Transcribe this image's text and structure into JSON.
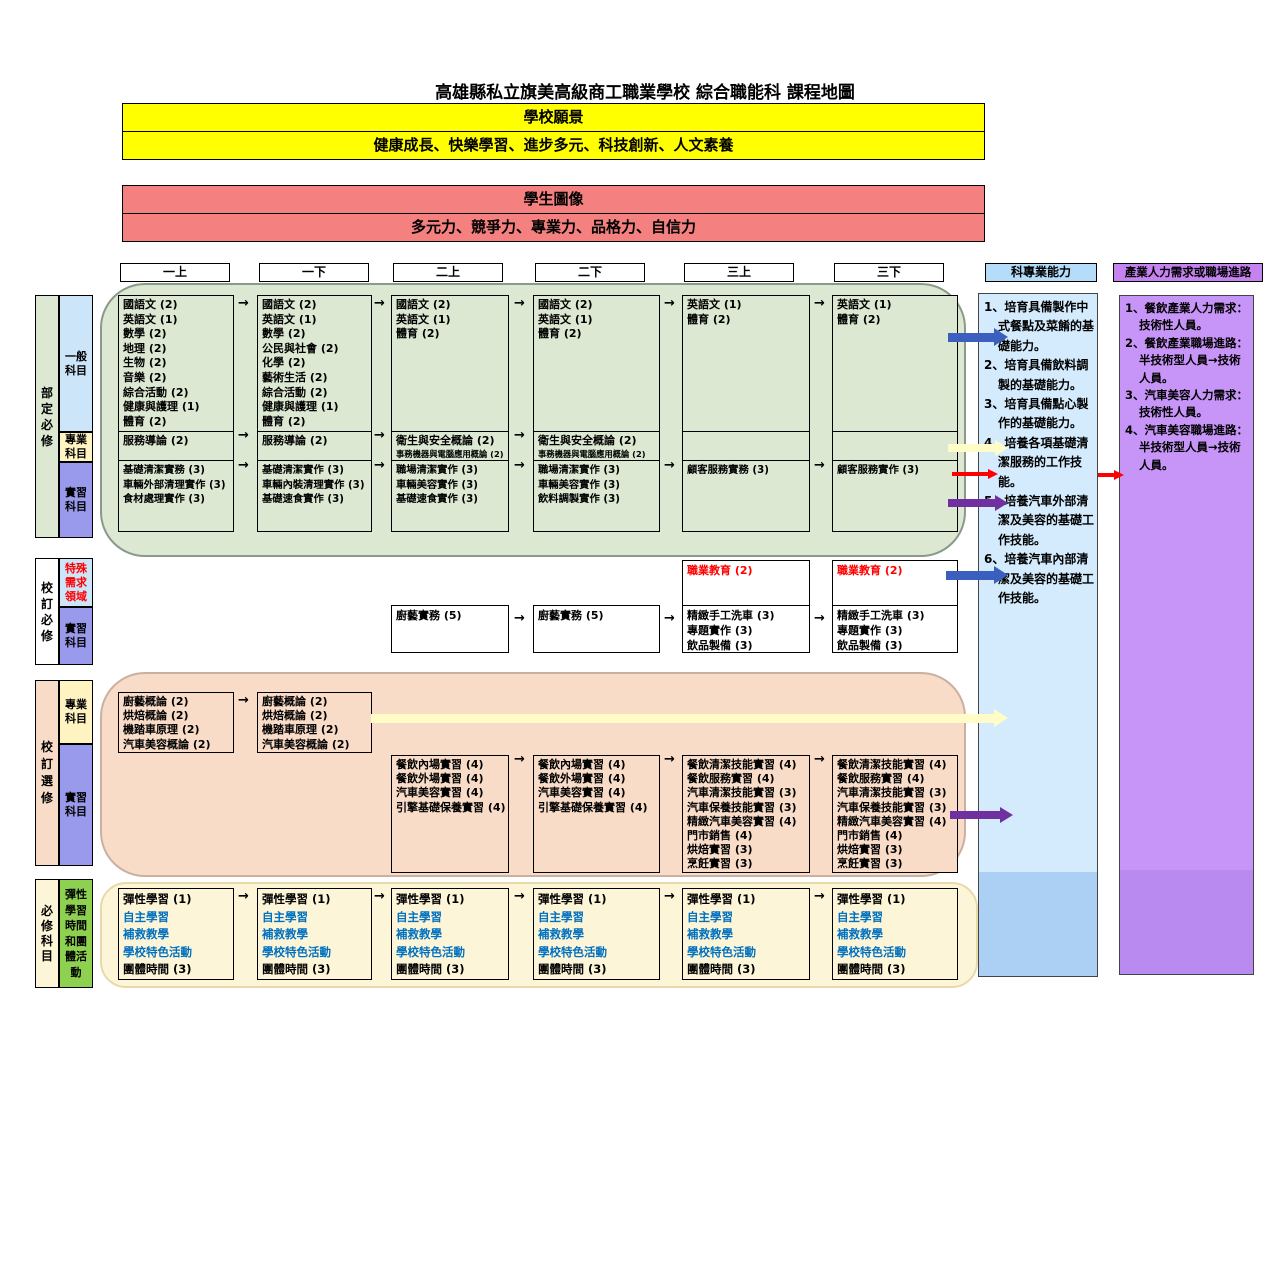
{
  "title": "高雄縣私立旗美高級商工職業學校 綜合職能科 課程地圖",
  "vision": {
    "header": "學校願景",
    "content": "健康成長、快樂學習、進步多元、科技創新、人文素養"
  },
  "student_image": {
    "header": "學生圖像",
    "content": "多元力、競爭力、專業力、品格力、自信力"
  },
  "semesters": [
    "一上",
    "一下",
    "二上",
    "二下",
    "三上",
    "三下"
  ],
  "panels": {
    "abilities": {
      "header": "科專業能力",
      "items": [
        "1、培育具備製作中式餐點及菜餚的基礎能力。",
        "2、培育具備飲料調製的基礎能力。",
        "3、培育具備點心製作的基礎能力。",
        "4、培養各項基礎清潔服務的工作技能。",
        "5、培養汽車外部清潔及美容的基礎工作技能。",
        "6、培養汽車內部清潔及美容的基礎工作技能。"
      ]
    },
    "industry": {
      "header": "產業人力需求或職場進路",
      "items": [
        "1、餐飲產業人力需求：技術性人員。",
        "2、餐飲產業職場進路：半技術型人員→技術人員。",
        "3、汽車美容人力需求：技術性人員。",
        "4、汽車美容職場進路：半技術型人員→技術人員。"
      ]
    }
  },
  "sections": {
    "ministry_required": {
      "label": "部定必修",
      "sub_labels": [
        "一般科目",
        "專業科目",
        "實習科目"
      ],
      "columns": [
        {
          "general": [
            "國語文 (2)",
            "英語文 (1)",
            "數學 (2)",
            "地理 (2)",
            "生物 (2)",
            "音樂 (2)",
            "綜合活動 (2)",
            "健康與護理 (1)",
            "體育 (2)"
          ],
          "professional": [
            "服務導論 (2)"
          ],
          "practicum": [
            "基礎清潔實務 (3)",
            "車輛外部清理實作 (3)",
            "食材處理實作 (3)"
          ]
        },
        {
          "general": [
            "國語文 (2)",
            "英語文 (1)",
            "數學 (2)",
            "公民與社會 (2)",
            "化學 (2)",
            "藝術生活 (2)",
            "綜合活動 (2)",
            "健康與護理 (1)",
            "體育 (2)"
          ],
          "professional": [
            "服務導論 (2)"
          ],
          "practicum": [
            "基礎清潔實作 (3)",
            "車輛內裝清理實作 (3)",
            "基礎速食實作 (3)"
          ]
        },
        {
          "general": [
            "國語文 (2)",
            "英語文 (1)",
            "體育 (2)"
          ],
          "professional": [
            "衛生與安全概論 (2)",
            {
              "t": "事務機器與電腦應用概論 (2)",
              "small": true
            }
          ],
          "practicum": [
            "職場清潔實作 (3)",
            "車輛美容實作 (3)",
            "基礎速食實作 (3)"
          ]
        },
        {
          "general": [
            "國語文 (2)",
            "英語文 (1)",
            "體育 (2)"
          ],
          "professional": [
            "衛生與安全概論 (2)",
            {
              "t": "事務機器與電腦應用概論 (2)",
              "small": true
            }
          ],
          "practicum": [
            "職場清潔實作 (3)",
            "車輛美容實作 (3)",
            "飲料調製實作 (3)"
          ]
        },
        {
          "general": [
            "英語文 (1)",
            "體育 (2)"
          ],
          "professional": [],
          "practicum": [
            "顧客服務實務 (3)"
          ]
        },
        {
          "general": [
            "英語文 (1)",
            "體育 (2)"
          ],
          "professional": [],
          "practicum": [
            "顧客服務實作 (3)"
          ]
        }
      ]
    },
    "school_required": {
      "label": "校訂必修",
      "sub_labels": [
        "特殊需求領域",
        "實習科目"
      ],
      "columns": [
        null,
        null,
        {
          "bottom": [
            "廚藝實務 (5)"
          ]
        },
        {
          "bottom": [
            "廚藝實務 (5)"
          ]
        },
        {
          "top": [
            {
              "t": "職業教育 (2)",
              "red": true
            }
          ],
          "bottom": [
            "精緻手工洗車 (3)",
            "專題實作 (3)",
            "飲品製備 (3)"
          ]
        },
        {
          "top": [
            {
              "t": "職業教育 (2)",
              "red": true
            }
          ],
          "bottom": [
            "精緻手工洗車 (3)",
            "專題實作 (3)",
            "飲品製備 (3)"
          ]
        }
      ]
    },
    "school_elective": {
      "label": "校訂選修",
      "sub_labels": [
        "專業科目",
        "實習科目"
      ],
      "columns": [
        {
          "professional": [
            "廚藝概論 (2)",
            "烘焙概論 (2)",
            "機踏車原理 (2)",
            "汽車美容概論 (2)"
          ]
        },
        {
          "professional": [
            "廚藝概論 (2)",
            "烘焙概論 (2)",
            "機踏車原理 (2)",
            "汽車美容概論 (2)"
          ]
        },
        {
          "practicum": [
            "餐飲內場實習 (4)",
            "餐飲外場實習 (4)",
            "汽車美容實習 (4)",
            "引擎基礎保養實習 (4)"
          ]
        },
        {
          "practicum": [
            "餐飲內場實習 (4)",
            "餐飲外場實習 (4)",
            "汽車美容實習 (4)",
            "引擎基礎保養實習 (4)"
          ]
        },
        {
          "practicum": [
            "餐飲清潔技能實習 (4)",
            "餐飲服務實習 (4)",
            "汽車清潔技能實習 (3)",
            "汽車保養技能實習 (3)",
            "精緻汽車美容實習 (4)",
            "門市銷售 (4)",
            "烘焙實習 (3)",
            "烹飪實習 (3)"
          ]
        },
        {
          "practicum": [
            "餐飲清潔技能實習 (4)",
            "餐飲服務實習 (4)",
            "汽車清潔技能實習 (3)",
            "汽車保養技能實習 (3)",
            "精緻汽車美容實習 (4)",
            "門市銷售 (4)",
            "烘焙實習 (3)",
            "烹飪實習 (3)"
          ]
        }
      ]
    },
    "flexible": {
      "label": "必修科目",
      "sub_label": "彈性學習時間和團體活動",
      "items": [
        {
          "t": "彈性學習 (1)"
        },
        {
          "t": "自主學習",
          "blue": true
        },
        {
          "t": "補救教學",
          "blue": true
        },
        {
          "t": "學校特色活動",
          "blue": true
        },
        {
          "t": "團體時間 (3)"
        }
      ]
    }
  },
  "colors": {
    "vision_bg": "#FFFF00",
    "student_bg": "#F58080",
    "ministry_bg": "#DCE8D2",
    "elective_bg": "#F9DCC8",
    "flexible_bg": "#FDF5D8",
    "general_label_bg": "#CDE5F8",
    "professional_label_bg": "#FFF4C1",
    "practicum_label_bg": "#9A9AEC",
    "flexible_label_bg": "#8ED050",
    "abilities_panel_bg": "#D3EBFC",
    "abilities_panel_bg_dark": "#ABD0F4",
    "abilities_header_bg": "#B5DCF8",
    "industry_panel_bg": "#C794F8",
    "industry_panel_bg_dark": "#B98AF0",
    "industry_header_bg": "#C583F0",
    "arrow_blue": "#3A5FBE",
    "arrow_yellow": "#FFFCC8",
    "arrow_purple": "#7030A0",
    "arrow_red": "#FF0000",
    "text_red": "#FF0000",
    "text_blue": "#0070C0"
  }
}
